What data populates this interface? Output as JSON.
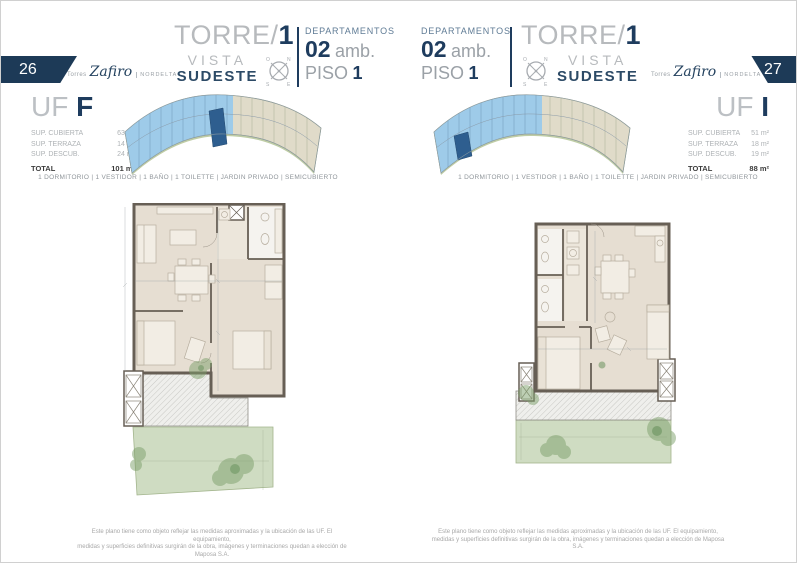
{
  "colors": {
    "brand_navy": "#1e3c5e",
    "muted_gray": "#b7babd",
    "tower1_blue": "#9ecbe9",
    "highlight_unit_blue": "#2e5e8f",
    "garden_green": "#cfdcc2"
  },
  "pages": {
    "left": {
      "page_number": "26",
      "brand": {
        "prefix": "Torres",
        "name": "Zafiro",
        "suffix": "NORDELTA"
      },
      "header": {
        "torre": "TORRE/",
        "torre_number": "1",
        "vista": "VISTA",
        "orientation": "SUDESTE",
        "departamentos": "DEPARTAMENTOS",
        "amb_number": "02",
        "amb_label": "amb.",
        "piso_label": "PISO",
        "piso_number": "1"
      },
      "unit": {
        "uf_label": "UF",
        "uf_letter": "F",
        "rows": [
          {
            "label": "SUP. CUBIERTA",
            "value": "63 m²"
          },
          {
            "label": "SUP. TERRAZA",
            "value": "14 m²"
          },
          {
            "label": "SUP. DESCUB.",
            "value": "24 m²"
          }
        ],
        "total_label": "TOTAL",
        "total_value": "101 m²"
      },
      "amenities": "1 DORMITORIO | 1 VESTIDOR | 1 BAÑO | 1 TOILETTE | JARDIN PRIVADO | SEMICUBIERTO",
      "disclaimer_line1": "Este plano tiene como objeto reflejar las medidas aproximadas y la ubicación de las UF. El equipamiento,",
      "disclaimer_line2": "medidas y superficies definitivas surgirán de la obra, imágenes y terminaciones quedan a elección de Maposa S.A."
    },
    "right": {
      "page_number": "27",
      "brand": {
        "prefix": "Torres",
        "name": "Zafiro",
        "suffix": "NORDELTA"
      },
      "header": {
        "torre": "TORRE/",
        "torre_number": "1",
        "vista": "VISTA",
        "orientation": "SUDESTE",
        "departamentos": "DEPARTAMENTOS",
        "amb_number": "02",
        "amb_label": "amb.",
        "piso_label": "PISO",
        "piso_number": "1"
      },
      "unit": {
        "uf_label": "UF",
        "uf_letter": "I",
        "rows": [
          {
            "label": "SUP. CUBIERTA",
            "value": "51 m²"
          },
          {
            "label": "SUP. TERRAZA",
            "value": "18 m²"
          },
          {
            "label": "SUP. DESCUB.",
            "value": "19 m²"
          }
        ],
        "total_label": "TOTAL",
        "total_value": "88 m²"
      },
      "amenities": "1 DORMITORIO | 1 VESTIDOR | 1 BAÑO | 1 TOILETTE | JARDIN PRIVADO | SEMICUBIERTO",
      "disclaimer_line1": "Este plano tiene como objeto reflejar las medidas aproximadas y la ubicación de las UF. El equipamiento,",
      "disclaimer_line2": "medidas y superficies definitivas surgirán de la obra, imágenes y terminaciones quedan a elección de Maposa S.A."
    }
  }
}
